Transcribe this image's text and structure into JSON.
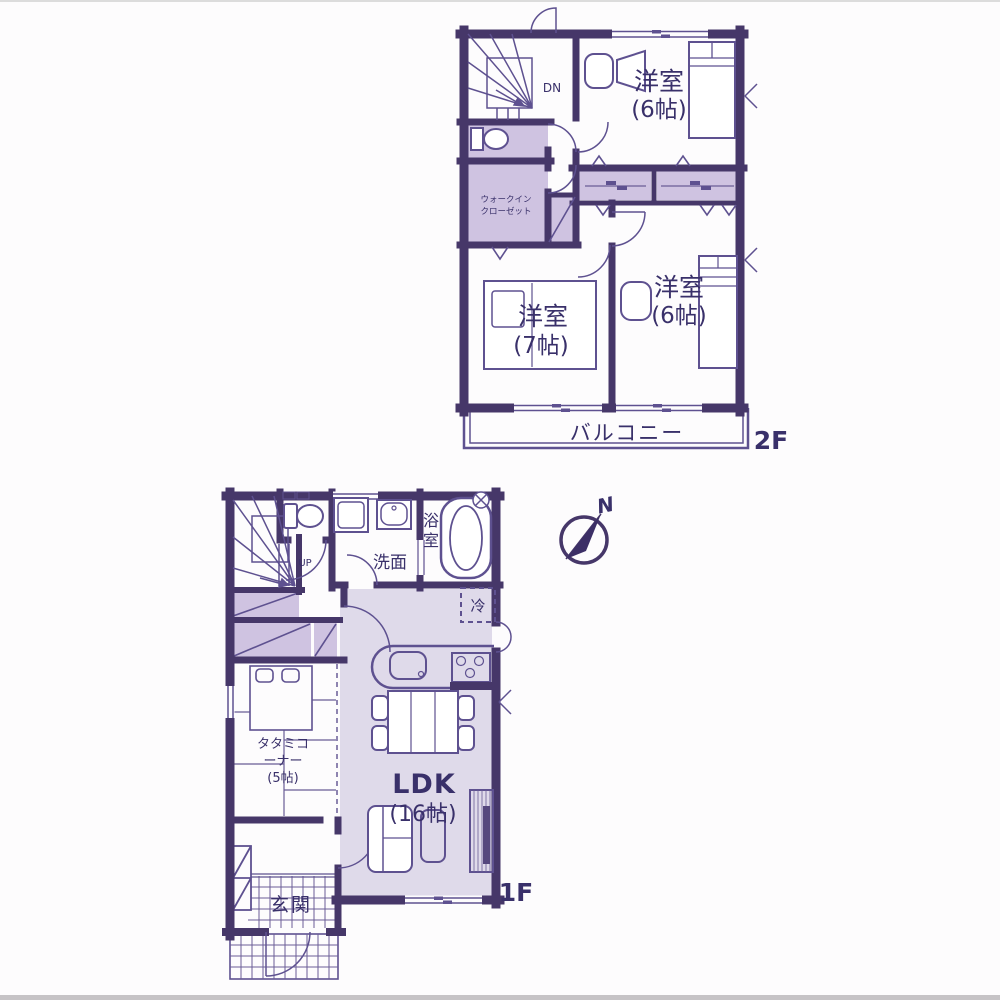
{
  "colors": {
    "wall": "#463769",
    "fixture_line": "#5e5190",
    "room_fill": "#cfc3e1",
    "ldk_fill": "#dfdaea",
    "text": "#39306a"
  },
  "floor2": {
    "floor_label": "2F",
    "stairs_label": "DN",
    "bedroom_top_name": "洋室",
    "bedroom_top_size": "(6帖)",
    "bedroom_left_name": "洋室",
    "bedroom_left_size": "(7帖)",
    "bedroom_right_name": "洋室",
    "bedroom_right_size": "(6帖)",
    "wic_line1": "ウォークイン",
    "wic_line2": "クローゼット",
    "balcony_label": "バルコニー"
  },
  "compass": {
    "north_label": "N"
  },
  "floor1": {
    "floor_label": "1F",
    "stairs_label": "UP",
    "washroom_label": "洗面",
    "bath_char1": "浴",
    "bath_char2": "室",
    "fridge_label": "冷",
    "ldk_name": "LDK",
    "ldk_size": "(16帖)",
    "tatami_line1": "タタミコ",
    "tatami_line2": "ーナー",
    "tatami_line3": "(5帖)",
    "entrance_label": "玄関"
  }
}
